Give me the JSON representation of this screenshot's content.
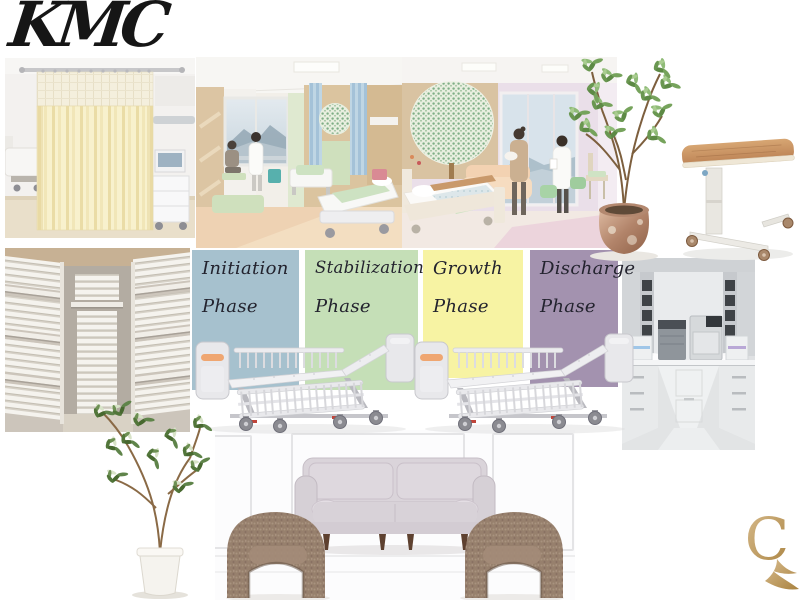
{
  "logo": {
    "text": "KMC"
  },
  "monogram": {
    "letter": "C"
  },
  "palette": {
    "card_text": "#23232e",
    "gold": "#b98f52",
    "phase_blue": "#a6c1ce",
    "phase_green": "#c5dfb7",
    "phase_yellow": "#f7f3a3",
    "phase_purple": "#a392af"
  },
  "phases": [
    {
      "line1": "Initiation",
      "line2": "Phase",
      "color": "#a6c1ce"
    },
    {
      "line1": "Stabilization",
      "line2": "Phase",
      "color": "#c5dfb7"
    },
    {
      "line1": "Growth",
      "line2": "Phase",
      "color": "#f7f3a3"
    },
    {
      "line1": "Discharge",
      "line2": "Phase",
      "color": "#a392af"
    }
  ],
  "images": {
    "curtain": "hospital-privacy-curtain-photo",
    "ward_green": "pediatric-ward-green-render",
    "ward_pink": "pediatric-ward-pink-render",
    "linen": "linen-storage-room-photo",
    "sterile": "sterilization-room-photo",
    "lounge": "waiting-lounge-sofa-photo",
    "bed": "hospital-bed-cutout",
    "table": "overbed-table-cutout",
    "tree": "potted-tree-cutout",
    "plant": "potted-plant-cutout"
  }
}
